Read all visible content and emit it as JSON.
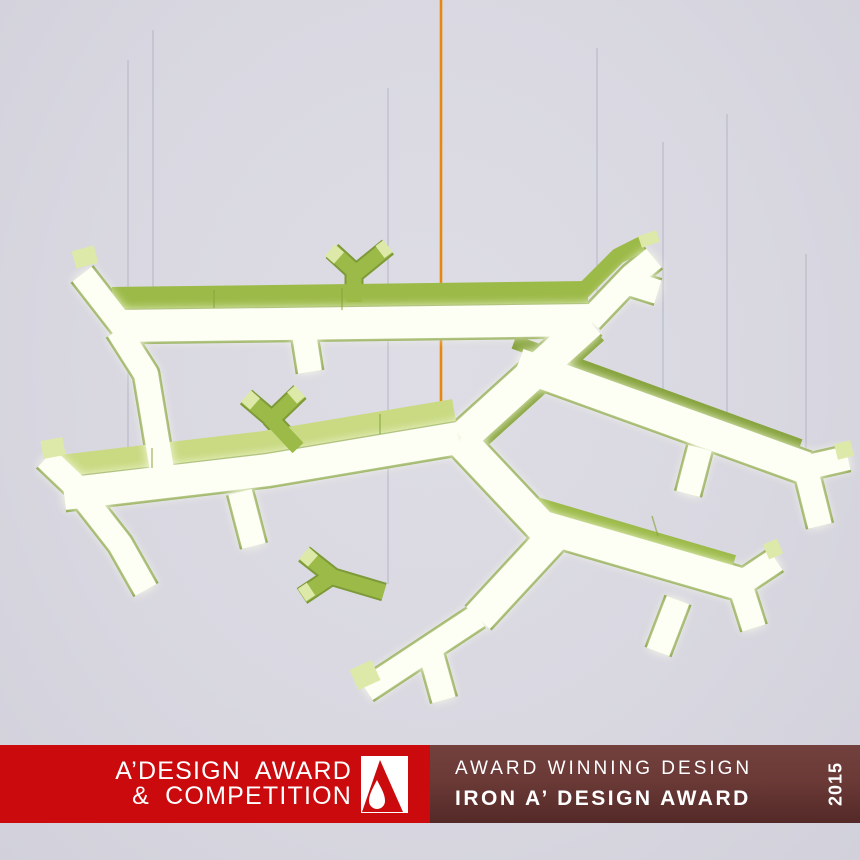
{
  "window": {
    "title": "A’ Design Award & Competition"
  },
  "colors": {
    "background": "#dbdae2",
    "banner-red": "#cb0a0d",
    "maroon-top": "#72403d",
    "maroon-mid": "#6b3a37",
    "maroon-bottom": "#532927",
    "banner-text": "#ffffff",
    "logo-white": "#ffffff",
    "lamp-green": "#9cba48",
    "lamp-green-light": "#c9da83",
    "lamp-green-pale": "#dde9a8",
    "lamp-green-dark": "#7d9a38",
    "lamp-green-shade": "#86a33c",
    "lamp-glow": "#fdfef4",
    "cable-orange": "#e8870f",
    "wire-gray": "#babdc9"
  },
  "scene": {
    "description": "Green branching tree-shaped pendant luminaire with glowing white undersides, suspended on thin gray wires and one orange power cable over a pale lavender background"
  },
  "banner": {
    "left": {
      "line1": "A’DESIGN AWARD",
      "line2": "& COMPETITION"
    },
    "logo": {
      "name": "a-design-award-mark"
    },
    "right": {
      "line1": "AWARD WINNING DESIGN",
      "line2": "IRON A’ DESIGN AWARD",
      "year": "2015"
    }
  }
}
